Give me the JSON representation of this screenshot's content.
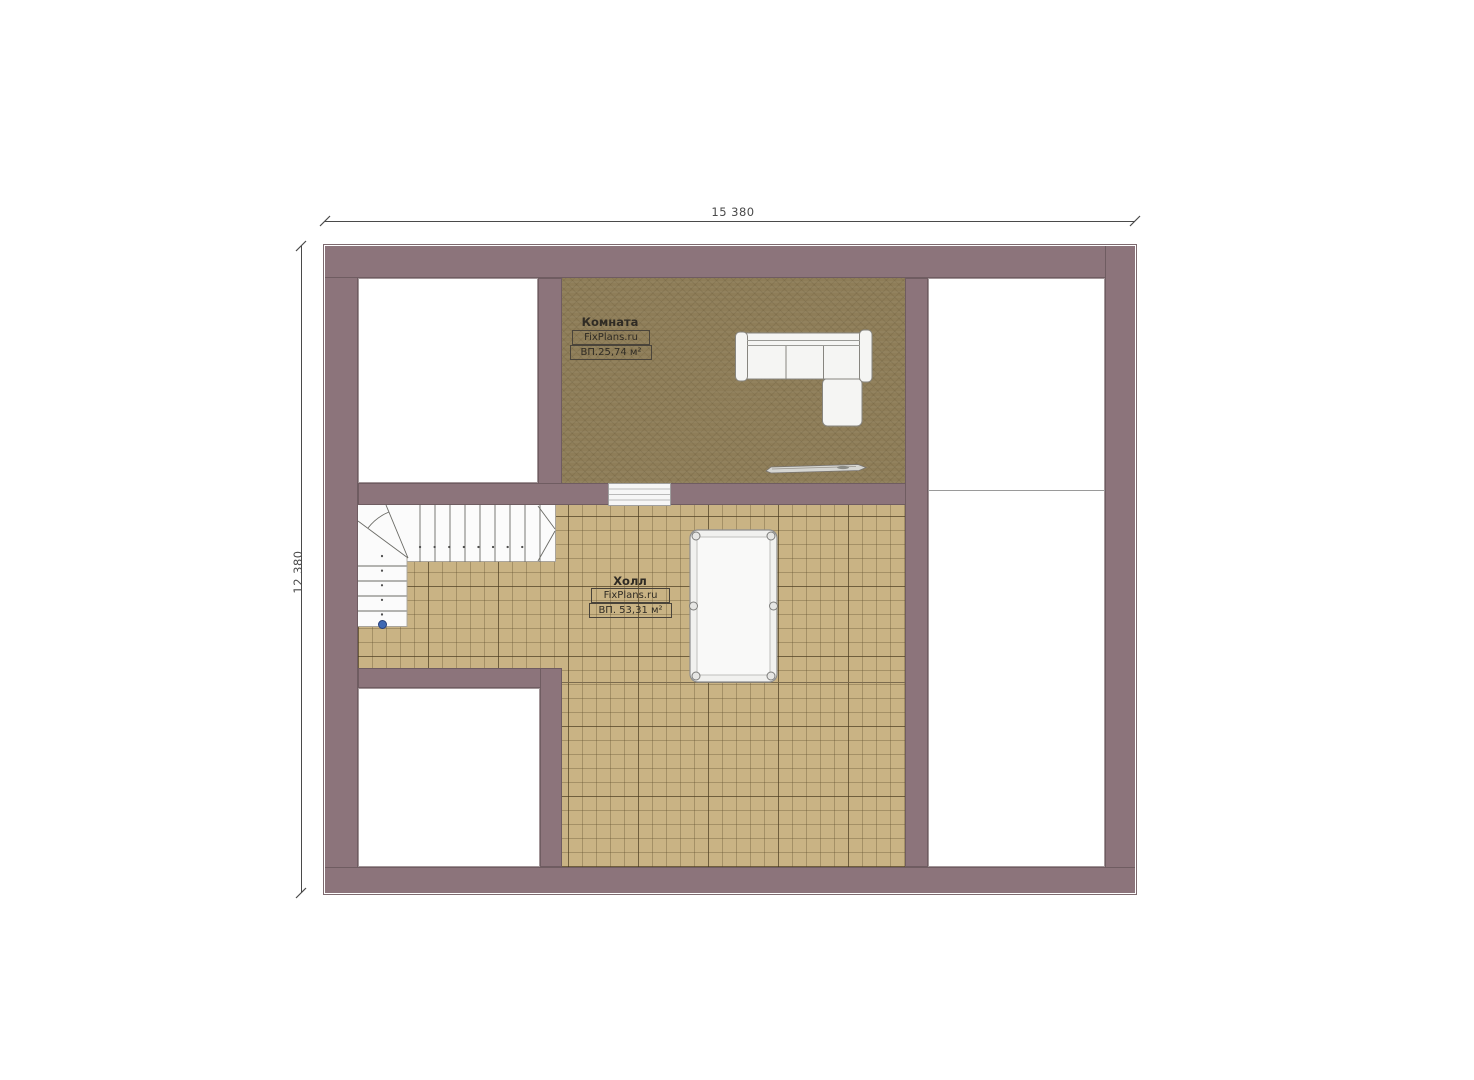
{
  "plan": {
    "dimensions": {
      "width_label": "15 380",
      "height_label": "12 380"
    },
    "rooms": {
      "komnata": {
        "name": "Комната",
        "brand": "FixPlans.ru",
        "area": "ВП.25,74 м²"
      },
      "holl": {
        "name": "Холл",
        "brand": "FixPlans.ru",
        "area": "ВП. 53,31 м²"
      }
    },
    "colors": {
      "wall": "#8c747b",
      "wall_edge": "#6f5c61",
      "komnata_floor": "#8e7d58",
      "holl_floor": "#c9b384",
      "white_room": "#ffffff",
      "stair_start_marker": "#3f69b4"
    },
    "furniture": [
      "corner-sofa",
      "billiard-table",
      "staircase",
      "skis"
    ]
  }
}
